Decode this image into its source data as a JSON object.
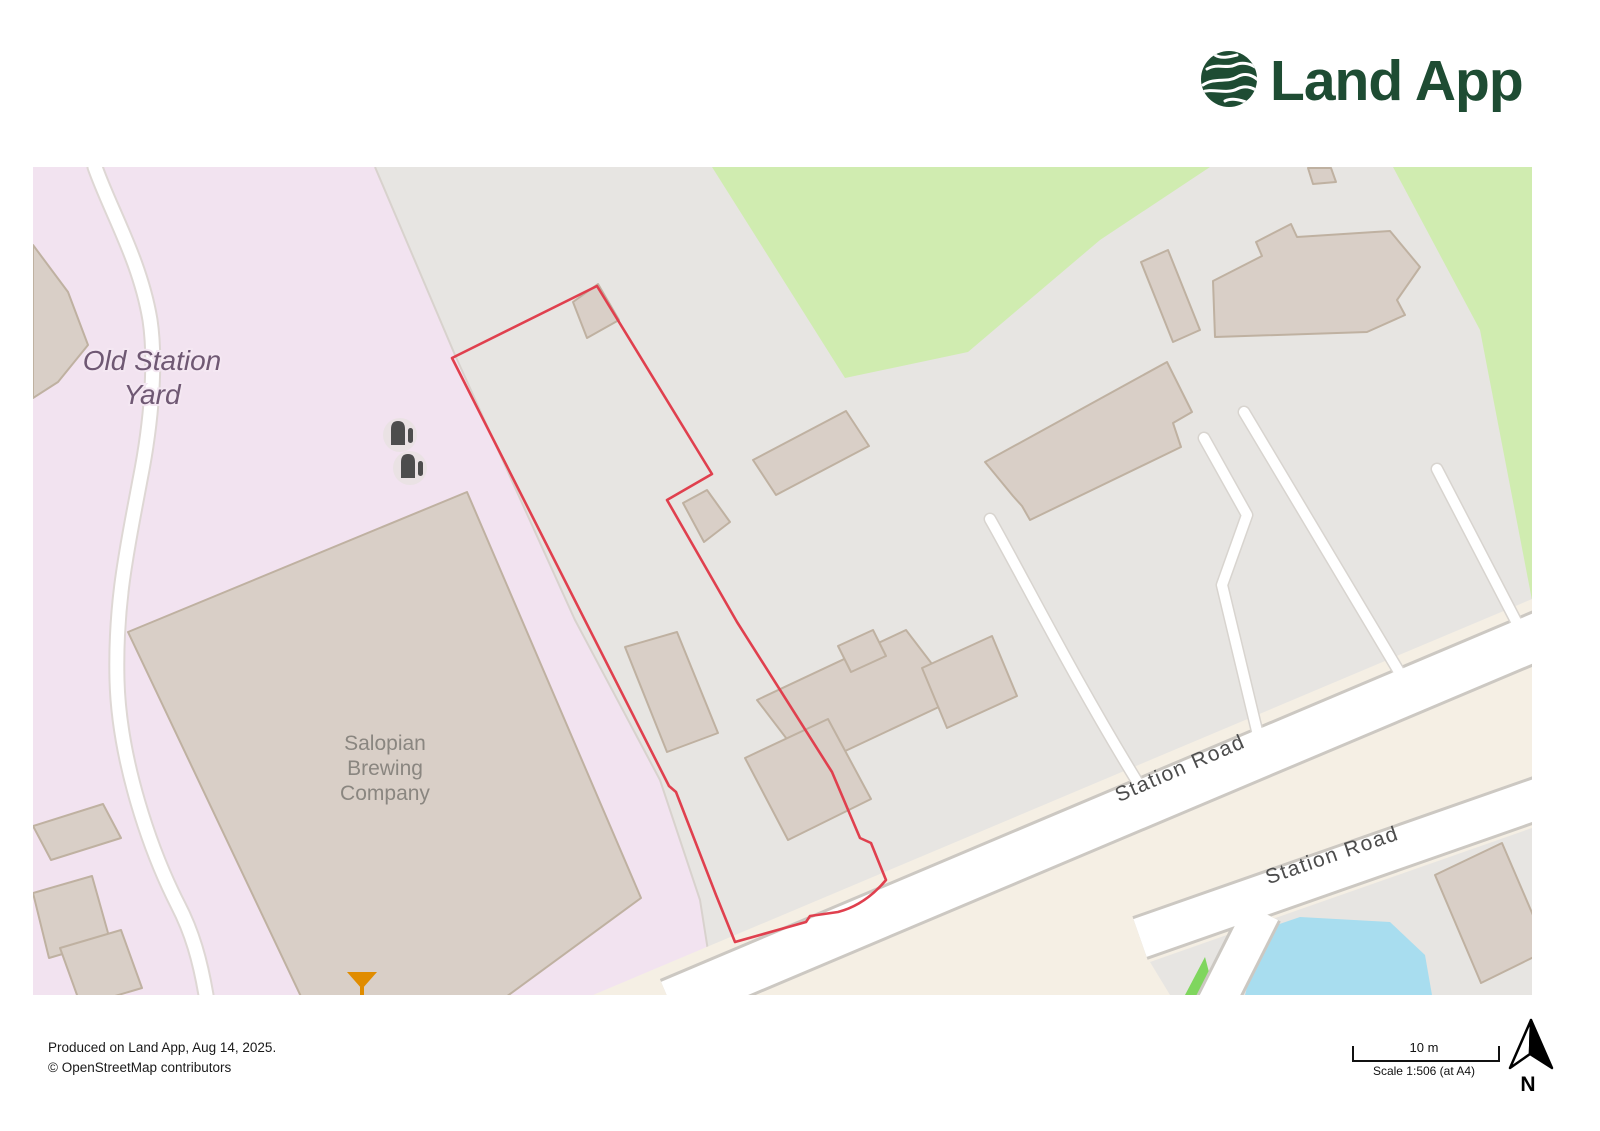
{
  "header": {
    "logo_text": "Land App"
  },
  "map": {
    "labels": {
      "area_line1": "Old Station",
      "area_line2": "Yard",
      "building_line1": "Salopian",
      "building_line2": "Brewing",
      "building_line3": "Company",
      "road_label_1": "Station Road",
      "road_label_2": "Station Road"
    },
    "icons": [
      "storage-tank-icon",
      "storage-tank-icon",
      "bar-martini-icon"
    ],
    "colors": {
      "parcel_boundary_red": "#e0404e",
      "railway_pink": "#f2e3f0",
      "parking_gray": "#e7e5e2",
      "grass_green": "#d0ecb0",
      "bright_green": "#7fd65e",
      "pond_blue": "#a8ddef",
      "building_beige": "#d9cfc7",
      "road_cream": "#f5efe4",
      "road_white": "#ffffff",
      "bar_icon_orange": "#e08c00",
      "logo_green": "#1e4c33"
    }
  },
  "footer": {
    "produced_line": "Produced on Land App, Aug 14, 2025.",
    "attribution_line": "© OpenStreetMap contributors"
  },
  "scalebar": {
    "distance_label": "10 m",
    "scale_label": "Scale 1:506 (at A4)"
  },
  "north": {
    "label": "N"
  }
}
